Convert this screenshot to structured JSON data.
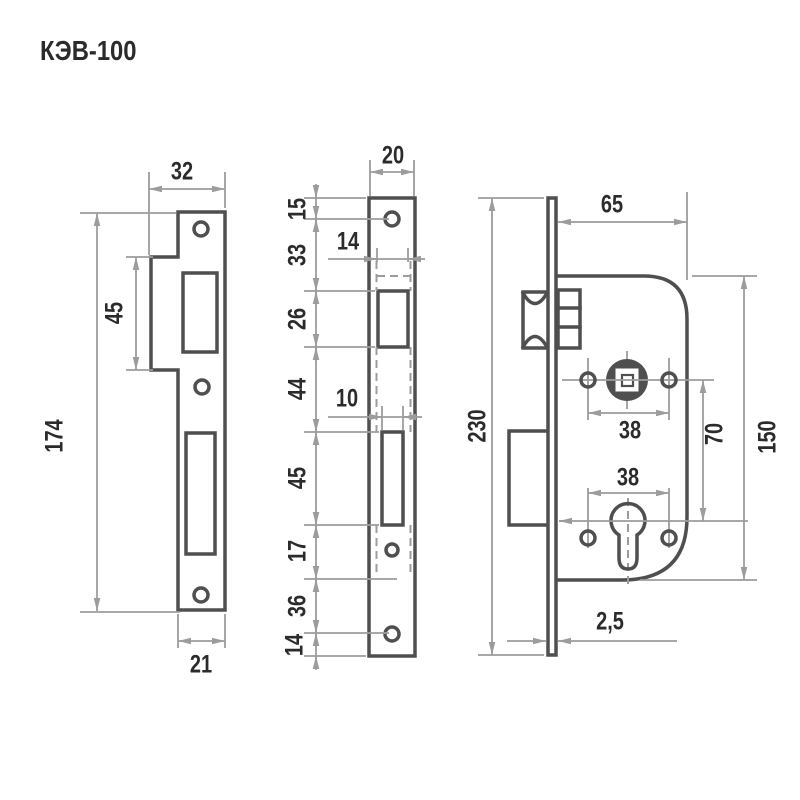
{
  "title": "КЭВ-100",
  "strike_plate": {
    "width_top": "32",
    "notch_height": "45",
    "total_height": "174",
    "width_bottom": "21"
  },
  "faceplate": {
    "width": "20",
    "seg_top_to_screw": "15",
    "seg_screw_to_latch": "33",
    "seg_latch_window": "26",
    "seg_latch_to_bolt": "44",
    "seg_bolt_window": "45",
    "seg_bolt_to_cyl": "17",
    "seg_cyl_to_screw": "36",
    "seg_screw_to_bottom": "14",
    "latch_width": "14",
    "bolt_width": "10"
  },
  "lock_body": {
    "backset_depth": "65",
    "faceplate_height": "230",
    "hub_screw_spacing": "38",
    "cyl_screw_spacing": "38",
    "hub_to_cylinder": "70",
    "body_height": "150",
    "plate_thickness": "2,5"
  }
}
